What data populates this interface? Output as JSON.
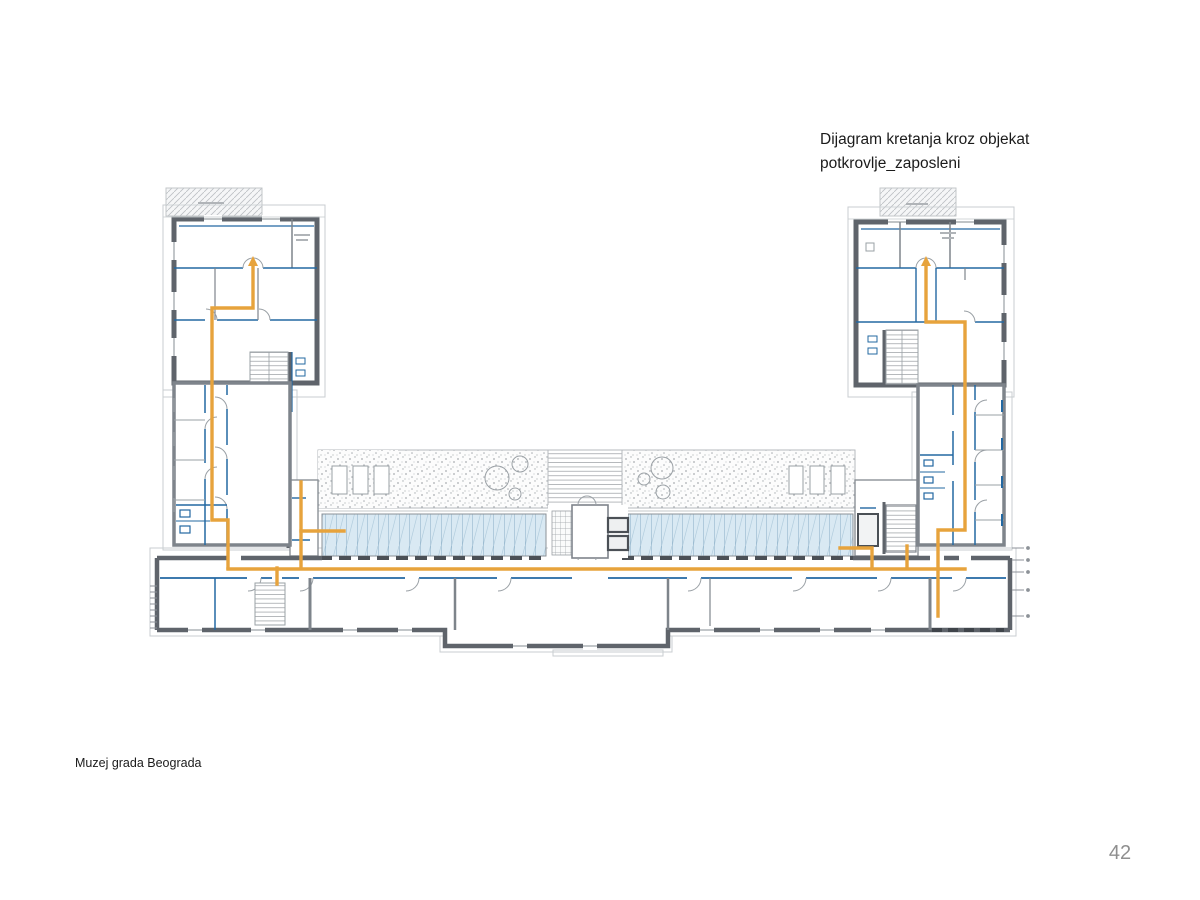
{
  "page": {
    "title_line1": "Dijagram kretanja kroz objekat",
    "title_line2": "potkrovlje_zaposleni",
    "footer": "Muzej grada Beograda",
    "page_number": "42"
  },
  "drawing": {
    "subject": "Dijagram kretanja kroz objekat — potkrovlje_zaposleni",
    "building": "Muzej grada Beograda",
    "colors": {
      "circulation_route": "#e7a33c",
      "partition_walls": "#2368a2",
      "structural_walls": "#5f646b",
      "glazing_fill": "#d9e9f3",
      "roof_outline": "#c3c7ca",
      "page_number_gray": "#8f8f8f"
    }
  }
}
